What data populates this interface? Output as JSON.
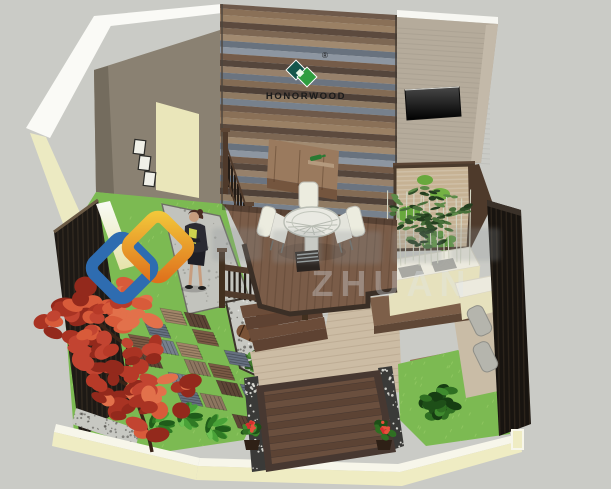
{
  "meta": {
    "title": "Courtyard garden 3D design rendering"
  },
  "brand": {
    "name": "HONORWOOD",
    "registered_mark": "®",
    "logo_color_dark": "#15564c",
    "logo_color_green": "#2f9e3f",
    "text_color": "#1b1b1b"
  },
  "watermark": {
    "legible_text": "ZHUAN",
    "diamond_blue": "#2e6cb0",
    "diamond_gold_start": "#f2c63a",
    "diamond_gold_end": "#df711c"
  },
  "palette": {
    "background": "#cacbc6",
    "grass": "#7cba52",
    "deck_wood": "#7a5c48",
    "dark_platform": "#5a4538",
    "cream_wall": "#efecc3",
    "taupe_wall": "#8a8172",
    "beige_wall": "#b5ab9b",
    "door_cream": "#eae6ba",
    "fence_dark": "#1d1915",
    "maple_red": "#c24431",
    "gravel": "#c7c8c2",
    "zen_sand": "#c6b294",
    "planter_white": "#eceade",
    "tv_black": "#111111"
  }
}
